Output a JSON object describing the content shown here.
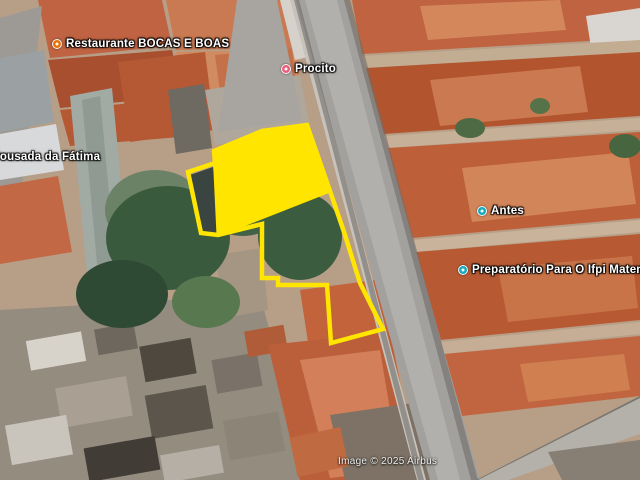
{
  "map": {
    "pois": [
      {
        "name": "restaurante",
        "label": "Restaurante BOCAS E BOAS",
        "color": "#e8710a"
      },
      {
        "name": "pousada",
        "label": "Pousada da Fátima",
        "color": ""
      },
      {
        "name": "procito",
        "label": "Procito",
        "color": "#e95d7d"
      },
      {
        "name": "antes",
        "label": "Antes",
        "color": "#16aabb"
      },
      {
        "name": "preparatorio",
        "label": "Preparatório Para O Ifpi Matemática E",
        "color": "#16aabb"
      }
    ],
    "attribution": "Image © 2025 Airbus",
    "parcel": {
      "color": "#ffe500"
    }
  }
}
